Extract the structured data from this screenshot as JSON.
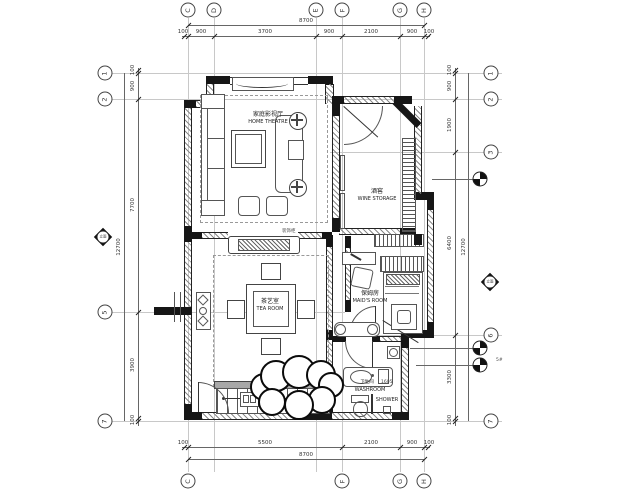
{
  "rooms": {
    "home_theatre": {
      "zh": "家庭影视厅",
      "en": "HOME THEATRE"
    },
    "wine_storage": {
      "zh": "酒窖",
      "en": "WINE STORAGE"
    },
    "tea_room": {
      "zh": "茶艺室",
      "en": "TEA ROOM"
    },
    "maids_room": {
      "zh": "保姆房",
      "en": "MAID'S ROOM"
    },
    "washroom": {
      "zh": "卫生间",
      "en": "WASHROOM"
    },
    "shower": {
      "en": "SHOWER"
    },
    "console": {
      "zh": "装饰柜"
    }
  },
  "grid": {
    "top": [
      "C",
      "D",
      "E",
      "F",
      "G",
      "H"
    ],
    "bottom": [
      "C",
      "F",
      "G",
      "H"
    ],
    "left": [
      "1",
      "2",
      "5",
      "7"
    ],
    "right": [
      "1",
      "2",
      "3",
      "6",
      "7"
    ]
  },
  "dims": {
    "top": {
      "total": "8700",
      "segments": [
        "100",
        "900",
        "3700",
        "900",
        "2100",
        "900",
        "100"
      ]
    },
    "bottom": {
      "total": "8700",
      "segments": [
        "100",
        "5500",
        "2100",
        "900",
        "100"
      ]
    },
    "left": {
      "total": "12700",
      "segments": [
        "100",
        "900",
        "7700",
        "3900",
        "100"
      ]
    },
    "right": {
      "total": "12700",
      "segments": [
        "100",
        "900",
        "1900",
        "6400",
        "3300",
        "100"
      ]
    }
  },
  "markers": {
    "elevation_label": "立面",
    "index_note": "5#",
    "vanity_code": "1605"
  },
  "colors": {
    "line": "#2a2a2a",
    "wall": "#161616",
    "grid": "#c8c8c8"
  }
}
